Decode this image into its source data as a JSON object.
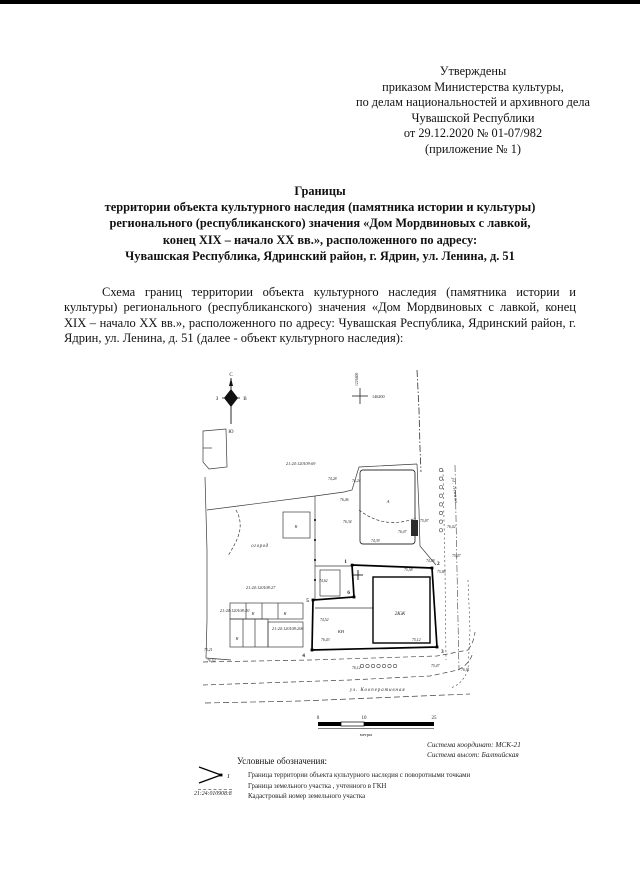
{
  "approval": {
    "lines": [
      "Утверждены",
      "приказом Министерства культуры,",
      "по делам национальностей и архивного дела",
      "Чувашской Республики",
      "от 29.12.2020 № 01-07/982",
      "(приложение № 1)"
    ]
  },
  "title": {
    "lines": [
      "Границы",
      "территории объекта культурного наследия (памятника истории и культуры)",
      "регионального (республиканского) значения «Дом Мордвиновых с лавкой,",
      "конец XIX – начало XX вв.», расположенного по адресу:",
      "Чувашская Республика, Ядринский район, г. Ядрин, ул. Ленина, д. 51"
    ]
  },
  "body": {
    "paragraph": "Схема границ территории объекта культурного наследия (памятника истории и культуры) регионального (республиканского) значения «Дом Мордвиновых с лавкой, конец XIX – начало XX вв.», расположенного по адресу: Чувашская Республика, Ядринский район, г. Ядрин, ул. Ленина, д. 51 (далее - объект культурного наследия):"
  },
  "map": {
    "compass": {
      "n": "С",
      "s": "Ю",
      "w": "З",
      "e": "В"
    },
    "grid": {
      "x_label": "146200",
      "y_label": "1226400"
    },
    "quarter_number": "21:24:120109:69",
    "parcels": {
      "p27": "21:24:120108:27",
      "p20": "21:24:120108:20",
      "p206": "21:24:120108:206"
    },
    "labels": {
      "garden": "огород",
      "heritage_building": "2КЖ",
      "nonres": "КН",
      "shed": "Н",
      "litera": "А",
      "street_bottom": "ул. Кооперативная",
      "street_right": "ул. Ленина"
    },
    "points": {
      "p1": "1",
      "p2": "2",
      "p3": "3",
      "p4": "4",
      "p5": "5",
      "p6": "6"
    },
    "elevations": [
      "74,28",
      "74,24",
      "76,46",
      "76,34",
      "74,39",
      "76,07",
      "75,87",
      "76,02",
      "75,47",
      "74,48",
      "75,58",
      "75,88",
      "74,62",
      "74,52",
      "76,43",
      "75,12",
      "76,12",
      "75,47",
      "76,91",
      "75,21",
      "76,52"
    ],
    "scalebar": {
      "t0": "0",
      "t10": "10",
      "t25": "25",
      "unit": "метры"
    }
  },
  "map_footer": {
    "coord_system": "Система координат: МСК-21",
    "height_system": "Система высот: Балтийская"
  },
  "legend": {
    "heading": "Условные обозначения:",
    "point_label": "1",
    "items": [
      {
        "text": "Граница территории объекта культурного наследия с поворотными точками"
      },
      {
        "text": "Граница земельного участка , учтенного в ГКН"
      },
      {
        "number": "21:24:010908:8",
        "text": "Кадастровый номер земельного участка"
      }
    ]
  }
}
